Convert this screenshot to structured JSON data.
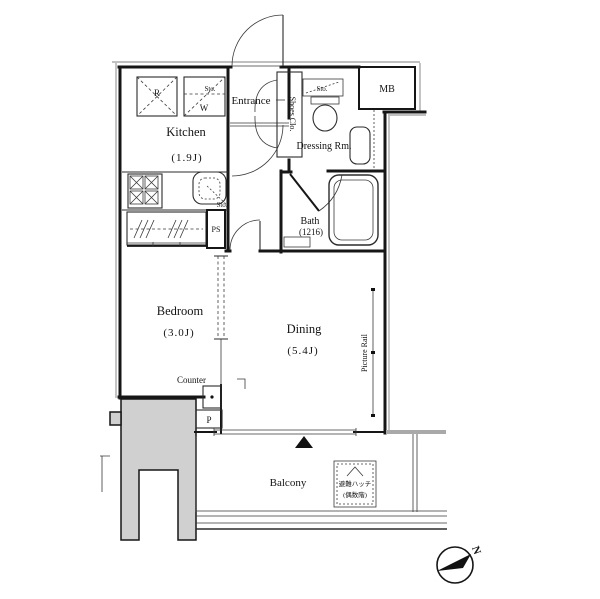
{
  "floorplan": {
    "rooms": {
      "kitchen": {
        "name": "Kitchen",
        "size": "(1.9J)"
      },
      "entrance": {
        "name": "Entrance"
      },
      "shoes_closet": {
        "name": "Shoes Clo."
      },
      "meter_box": {
        "name": "MB"
      },
      "dressing_room": {
        "name": "Dressing Rm."
      },
      "bath": {
        "name": "Bath",
        "size": "(1216)"
      },
      "pipe_space": {
        "name": "PS"
      },
      "bedroom": {
        "name": "Bedroom",
        "size": "(3.0J)"
      },
      "dining": {
        "name": "Dining",
        "size": "(5.4J)"
      },
      "balcony": {
        "name": "Balcony"
      }
    },
    "labels": {
      "refrigerator": "R",
      "washer": "W",
      "storage": "Sto.",
      "counter": "Counter",
      "pillar": "P",
      "picture_rail": "Picture Rail",
      "escape_hatch_line1": "避難ハッチ",
      "escape_hatch_line2": "(偶数階)",
      "compass_north": "N"
    },
    "colors": {
      "wall": "#161616",
      "concrete_fill": "#d0d0d0",
      "background": "#ffffff"
    }
  }
}
